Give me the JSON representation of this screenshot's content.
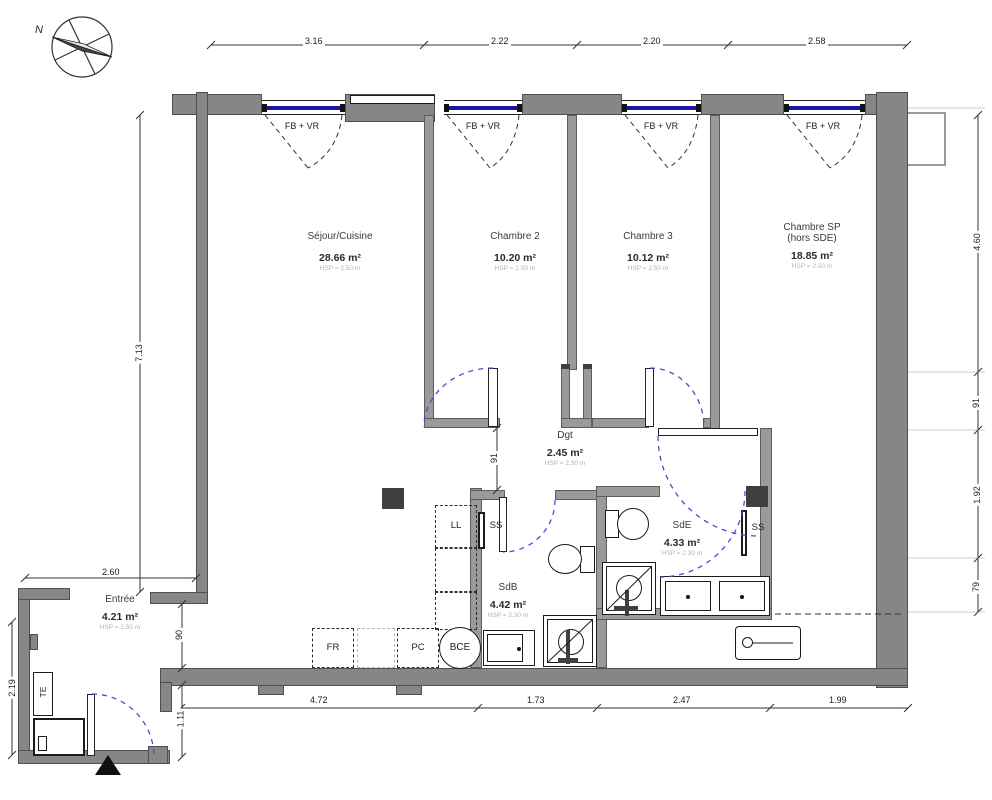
{
  "title": "Plan d'appartement",
  "compass": {
    "north_label": "N"
  },
  "windows": {
    "label": "FB + VR"
  },
  "rooms": [
    {
      "id": "sejour",
      "name": "Séjour/Cuisine",
      "area": "28.66 m²",
      "hsp": "HSP = 2.50 m"
    },
    {
      "id": "chambre2",
      "name": "Chambre 2",
      "area": "10.20 m²",
      "hsp": "HSP = 2.50 m"
    },
    {
      "id": "chambre3",
      "name": "Chambre 3",
      "area": "10.12 m²",
      "hsp": "HSP = 2.50 m"
    },
    {
      "id": "chambre_sp",
      "name": "Chambre SP",
      "name2": "(hors SDE)",
      "area": "18.85 m²",
      "hsp": "HSP = 2.50 m"
    },
    {
      "id": "dgt",
      "name": "Dgt",
      "area": "2.45 m²",
      "hsp": "HSP = 2.50 m"
    },
    {
      "id": "sdb",
      "name": "SdB",
      "area": "4.42 m²",
      "hsp": "HSP = 2.30 m"
    },
    {
      "id": "sde",
      "name": "SdE",
      "area": "4.33 m²",
      "hsp": "HSP = 2.30 m"
    },
    {
      "id": "entree",
      "name": "Entrée",
      "area": "4.21 m²",
      "hsp": "HSP = 2.50 m"
    }
  ],
  "equipment": {
    "fridge": "FR",
    "hob": "PC",
    "water_heater": "BCE",
    "washing_machine": "LL",
    "towel_rail_sdb": "SS",
    "towel_rail_sde": "SS",
    "electrical_panel": "TE"
  },
  "dimensions": {
    "top": [
      "3.16",
      "2.22",
      "2.20",
      "2.58"
    ],
    "bottom": [
      "4.72",
      "1.73",
      "2.47",
      "1.99"
    ],
    "left_height": "7.13",
    "wing_width": "2.60",
    "wing_height": "2.19",
    "passage_opening": "90",
    "entry_door": "1.11",
    "dgt_width": "91",
    "right": [
      "4.60",
      "91",
      "1.92",
      "79"
    ]
  },
  "colors": {
    "wall": "#868686",
    "window_glass": "#1a16a8",
    "door_arc": "#4b4bd0",
    "window_arc": "#333333"
  }
}
